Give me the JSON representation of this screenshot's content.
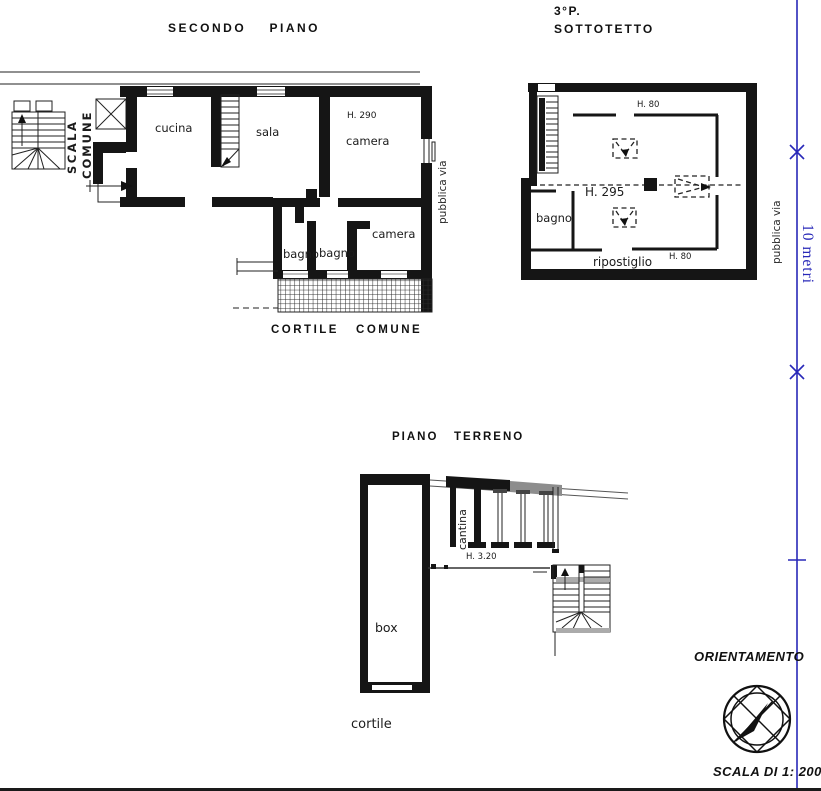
{
  "titles": {
    "secondo_piano": "SECONDO    PIANO",
    "sottotetto_p": "3°P.",
    "sottotetto": "SOTTOTETTO",
    "cortile_comune": "CORTILE   COMUNE",
    "piano_terreno": "PIANO   TERRENO",
    "orientamento": "ORIENTAMENTO",
    "scala": "SCALA DI 1: 200"
  },
  "floor2": {
    "cucina": "cucina",
    "sala": "sala",
    "h290": "H. 290",
    "camera_top": "camera",
    "bagno_left": "bagno",
    "bagno_right": "bagno",
    "camera_bottom": "camera",
    "scala_line1": "SCALA",
    "scala_line2": "COMUNE",
    "pubblica_via": "pubblica via"
  },
  "attic": {
    "h80_top": "H. 80",
    "h295": "H. 295",
    "bagno": "bagno",
    "ripostiglio": "ripostiglio",
    "h80_bottom": "H. 80",
    "pubblica_via": "pubblica via"
  },
  "ground": {
    "cantina": "cantina",
    "h320": "H. 3.20",
    "box": "box",
    "cortile": "cortile"
  },
  "measure": {
    "label": "10 metri"
  },
  "colors": {
    "wall": "#151515",
    "measure_blue": "#2828b8",
    "paper": "#ffffff"
  }
}
